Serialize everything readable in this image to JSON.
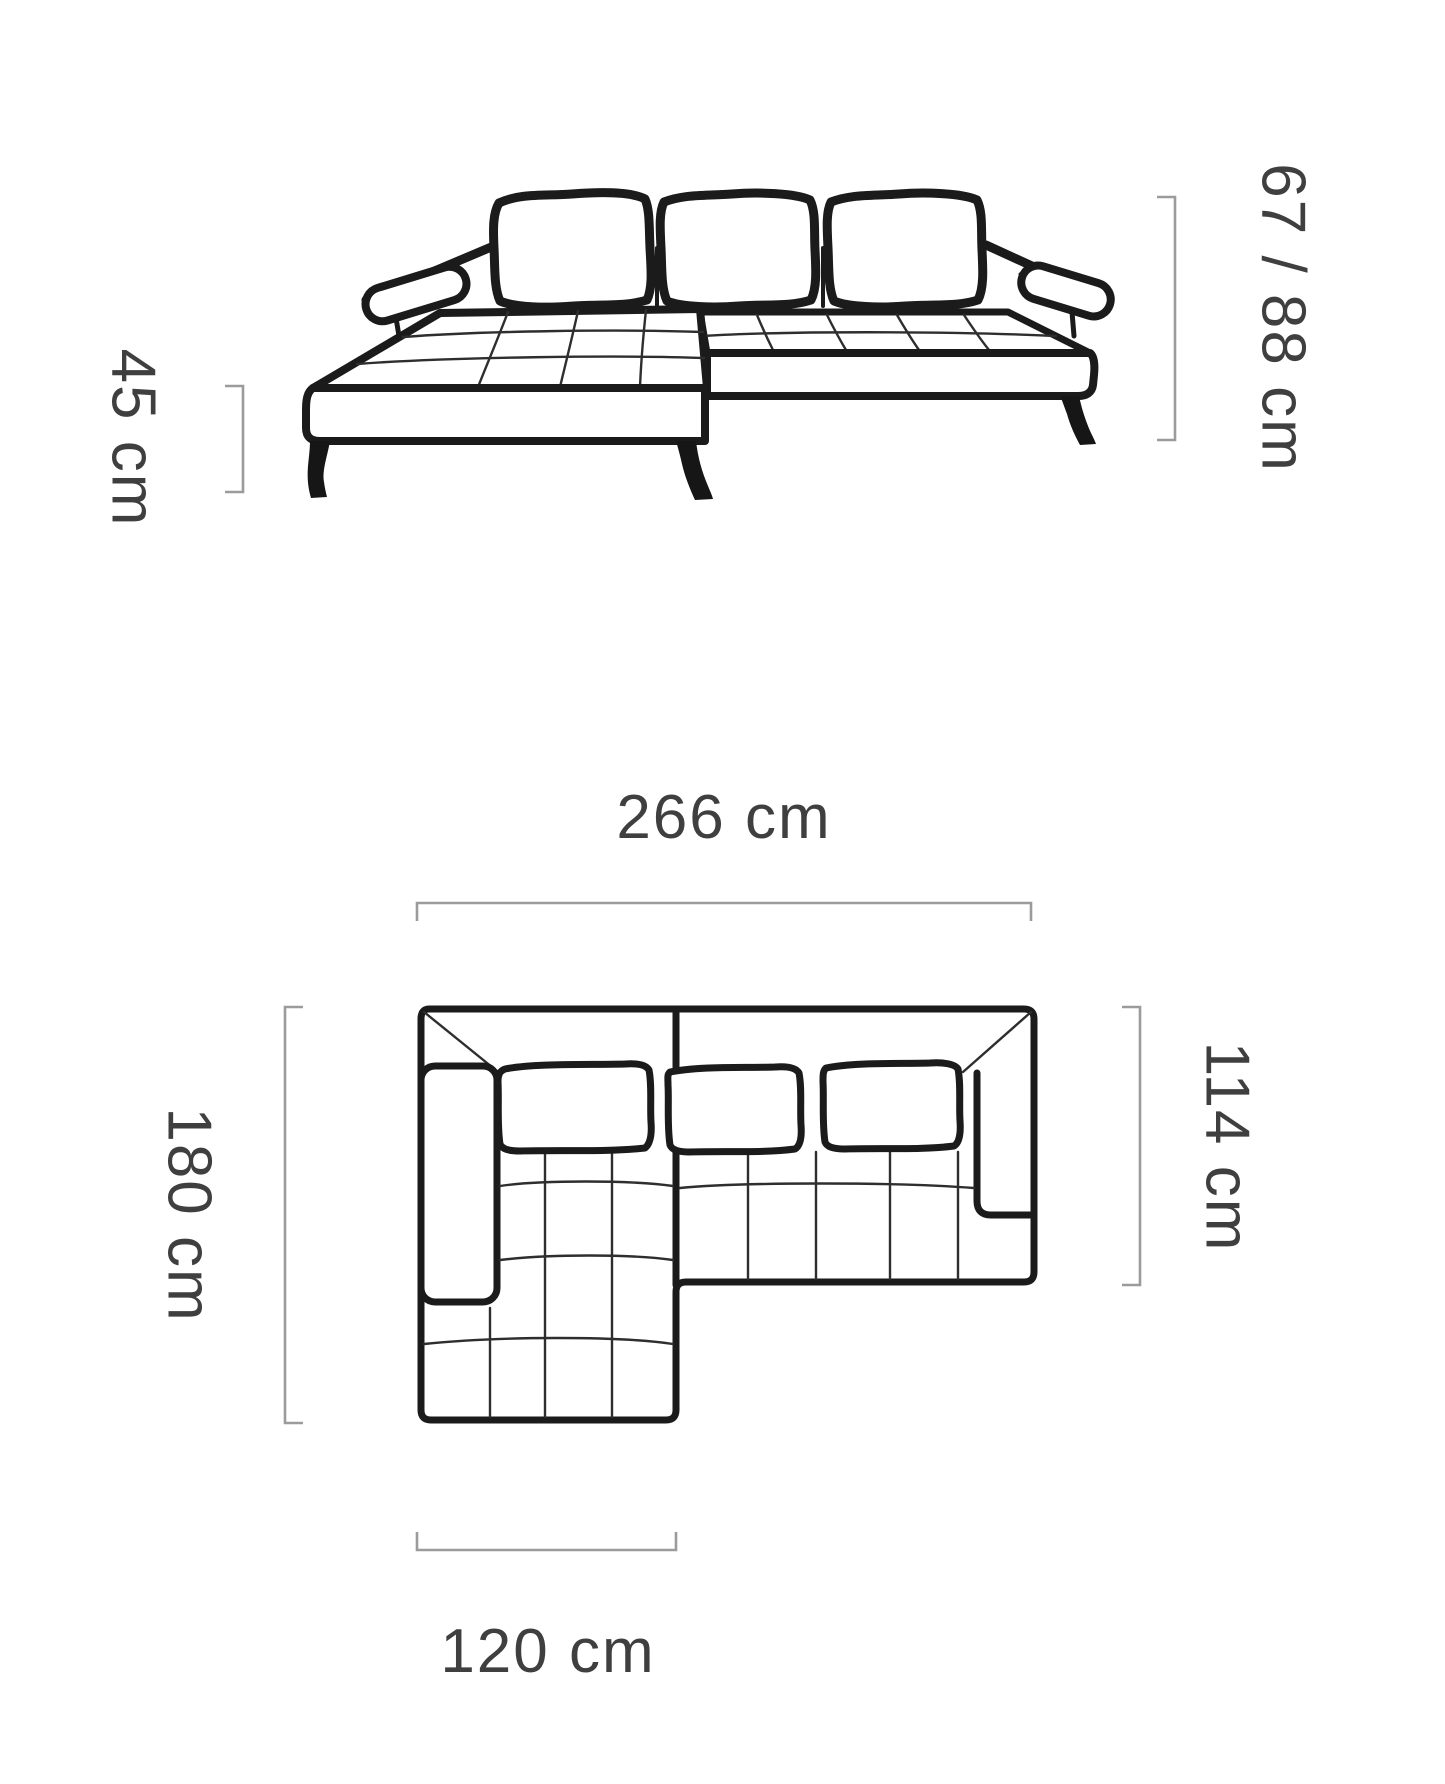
{
  "diagram": {
    "type": "corner-sofa dimension drawing",
    "views": {
      "front": "front elevation of corner sofa",
      "top": "top plan of corner sofa"
    }
  },
  "labels": {
    "seat_height": "45 cm",
    "backrest_height": "67 / 88 cm",
    "total_width": "266 cm",
    "total_depth": "180 cm",
    "body_depth": "114 cm",
    "chaise_width": "120 cm"
  },
  "colors": {
    "background": "#ffffff",
    "drawing_line": "#1b1b1b",
    "dimension_bracket": "#9b9b9b",
    "dimension_text": "#3f3f3f"
  }
}
